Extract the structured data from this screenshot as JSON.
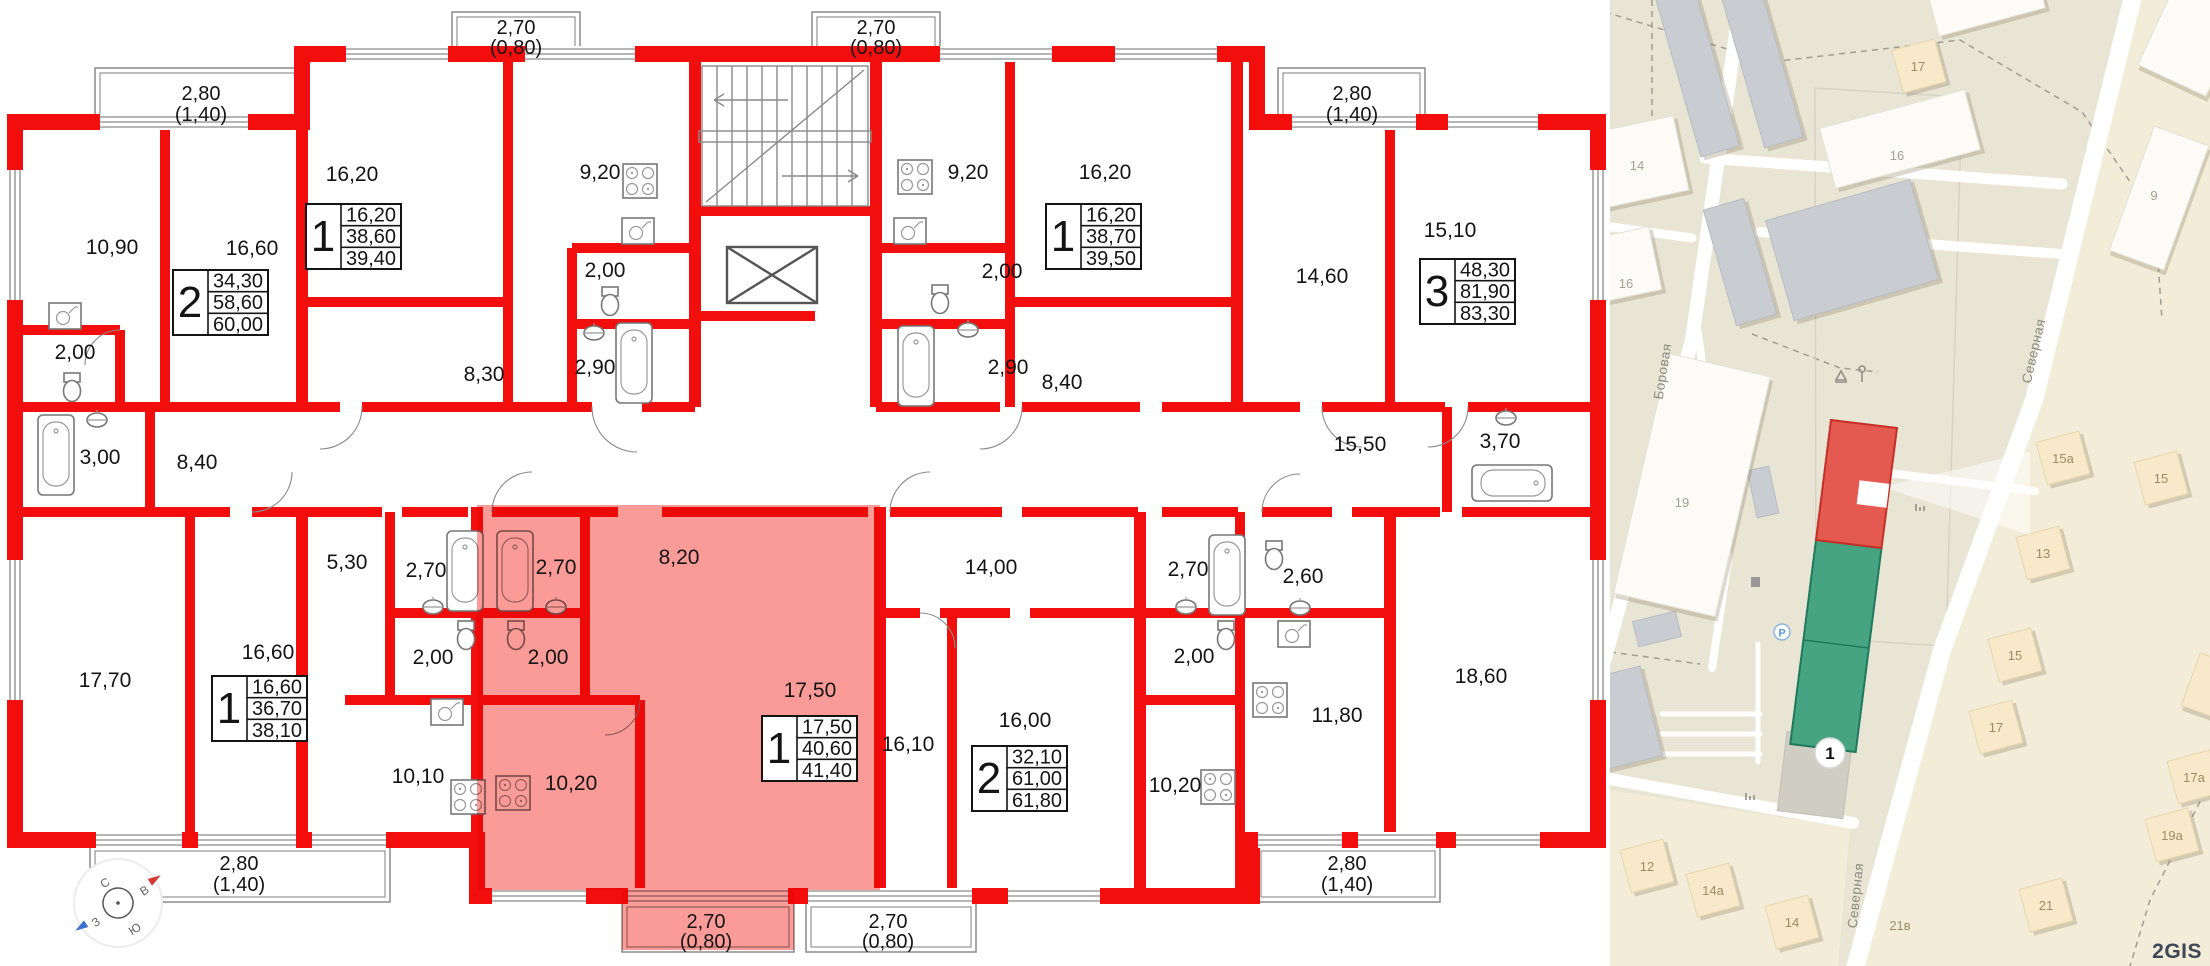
{
  "floorplan": {
    "colors": {
      "wall": "#f30e0e",
      "highlight": "#fa9b97"
    },
    "areas": {
      "a1090": "10,90",
      "a1660t": "16,60",
      "a1620l": "16,20",
      "a920l": "9,20",
      "a200l1": "2,00",
      "a290l": "2,90",
      "a830": "8,30",
      "a200fl": "2,00",
      "a300": "3,00",
      "a840l": "8,40",
      "a920r": "9,20",
      "a200r1": "2,00",
      "a290r": "2,90",
      "a1620r": "16,20",
      "a840r": "8,40",
      "a1460": "14,60",
      "a1510": "15,10",
      "a1550": "15,50",
      "a370": "3,70",
      "a1770": "17,70",
      "a1660b": "16,60",
      "a530": "5,30",
      "a270l": "2,70",
      "a200l2": "2,00",
      "a1010": "10,10",
      "a270h": "2,70",
      "a200h": "2,00",
      "a820": "8,20",
      "a1020h": "10,20",
      "a1750": "17,50",
      "a1610": "16,10",
      "a1400": "14,00",
      "a1600": "16,00",
      "a270r": "2,70",
      "a200r2": "2,00",
      "a1020r": "10,20",
      "a260": "2,60",
      "a1180": "11,80",
      "a1860": "18,60"
    },
    "dims": {
      "tl": {
        "a": "2,80",
        "b": "(1,40)"
      },
      "tc1": {
        "a": "2,70",
        "b": "(0,80)"
      },
      "tc2": {
        "a": "2,70",
        "b": "(0,80)"
      },
      "tr": {
        "a": "2,80",
        "b": "(1,40)"
      },
      "bl": {
        "a": "2,80",
        "b": "(1,40)"
      },
      "bc1": {
        "a": "2,70",
        "b": "(0,80)"
      },
      "bc2": {
        "a": "2,70",
        "b": "(0,80)"
      },
      "br": {
        "a": "2,80",
        "b": "(1,40)"
      }
    },
    "apartments": {
      "left2": {
        "num": "2",
        "v1": "34,30",
        "v2": "58,60",
        "v3": "60,00"
      },
      "topLeft1": {
        "num": "1",
        "v1": "16,20",
        "v2": "38,60",
        "v3": "39,40"
      },
      "topRight1": {
        "num": "1",
        "v1": "16,20",
        "v2": "38,70",
        "v3": "39,50"
      },
      "right3": {
        "num": "3",
        "v1": "48,30",
        "v2": "81,90",
        "v3": "83,30"
      },
      "bottomLeft1": {
        "num": "1",
        "v1": "16,60",
        "v2": "36,70",
        "v3": "38,10"
      },
      "selected1": {
        "num": "1",
        "v1": "17,50",
        "v2": "40,60",
        "v3": "41,40"
      },
      "bottomRight2": {
        "num": "2",
        "v1": "32,10",
        "v2": "61,00",
        "v3": "61,80"
      }
    },
    "compass": {
      "n": "С",
      "e": "В",
      "s": "Ю",
      "w": "З"
    }
  },
  "map": {
    "colors": {
      "selected_red": "#e45a50",
      "selected_green": "#46a482",
      "land": "#e9e5d5"
    },
    "streets": {
      "borovaya": "Боровая",
      "severnaya1": "Северная",
      "severnaya2": "Северная"
    },
    "buildings": {
      "b17t": "17",
      "b14": "14",
      "b16l": "16",
      "b16c": "16",
      "b9": "9",
      "b19": "19",
      "b15a": "15а",
      "b15r": "15",
      "b13": "13",
      "b15b": "15",
      "b17m": "17",
      "b17a": "17а",
      "b19a": "19а",
      "b21": "21",
      "b12": "12",
      "b14a": "14а",
      "b14b": "14",
      "b21v": "21в"
    },
    "marker": "1",
    "parking": "P",
    "logo": "2GIS"
  }
}
